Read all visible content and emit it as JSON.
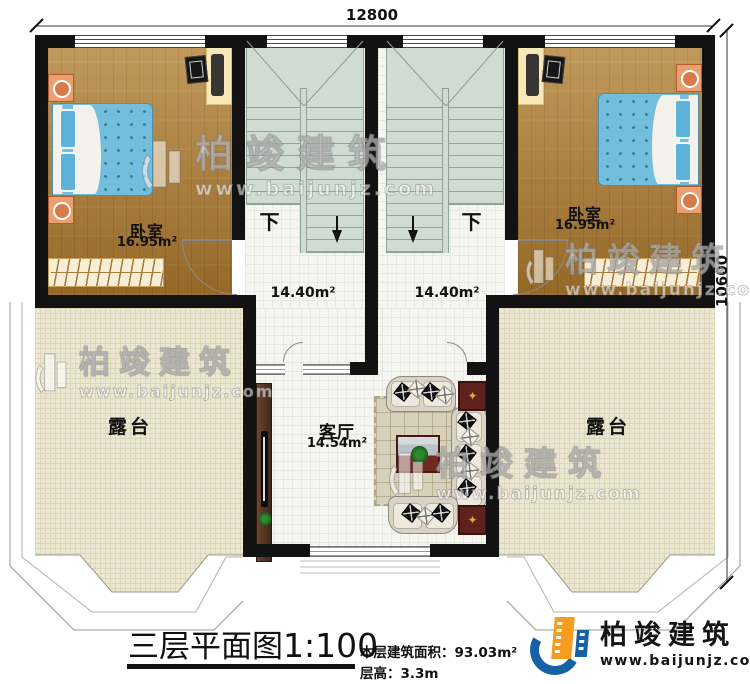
{
  "dimensions": {
    "top": "12800",
    "right": "10600"
  },
  "rooms": {
    "bedroom_left": {
      "name": "卧室",
      "area": "16.95m²"
    },
    "bedroom_right": {
      "name": "卧室",
      "area": "16.95m²"
    },
    "stair_hall_left": {
      "down": "下",
      "area": "14.40m²"
    },
    "stair_hall_right": {
      "down": "下",
      "area": "14.40m²"
    },
    "living_room": {
      "name": "客厅",
      "area": "14.54m²"
    },
    "terrace_left": {
      "name": "露台"
    },
    "terrace_right": {
      "name": "露台"
    }
  },
  "title_block": {
    "title": "三层平面图",
    "scale": "1:100",
    "floor_area_label": "本层建筑面积：",
    "floor_area_value": "93.03m²",
    "floor_height_label": "层高：",
    "floor_height_value": "3.3m"
  },
  "brand": {
    "name": "柏竣建筑",
    "website": "www.baijunjz.com"
  },
  "watermark": {
    "name": "柏竣建筑",
    "website": "www.baijunjz.com"
  },
  "colors": {
    "wall": "#121212",
    "wood_floor": "#ab7a30",
    "terrace_floor": "#ece7d3",
    "stair": "#cfdbd3",
    "bed_blue": "#74bedd",
    "logo_blue": "#1660a8",
    "logo_orange": "#f59d20",
    "maroon_table": "#5e211c"
  }
}
